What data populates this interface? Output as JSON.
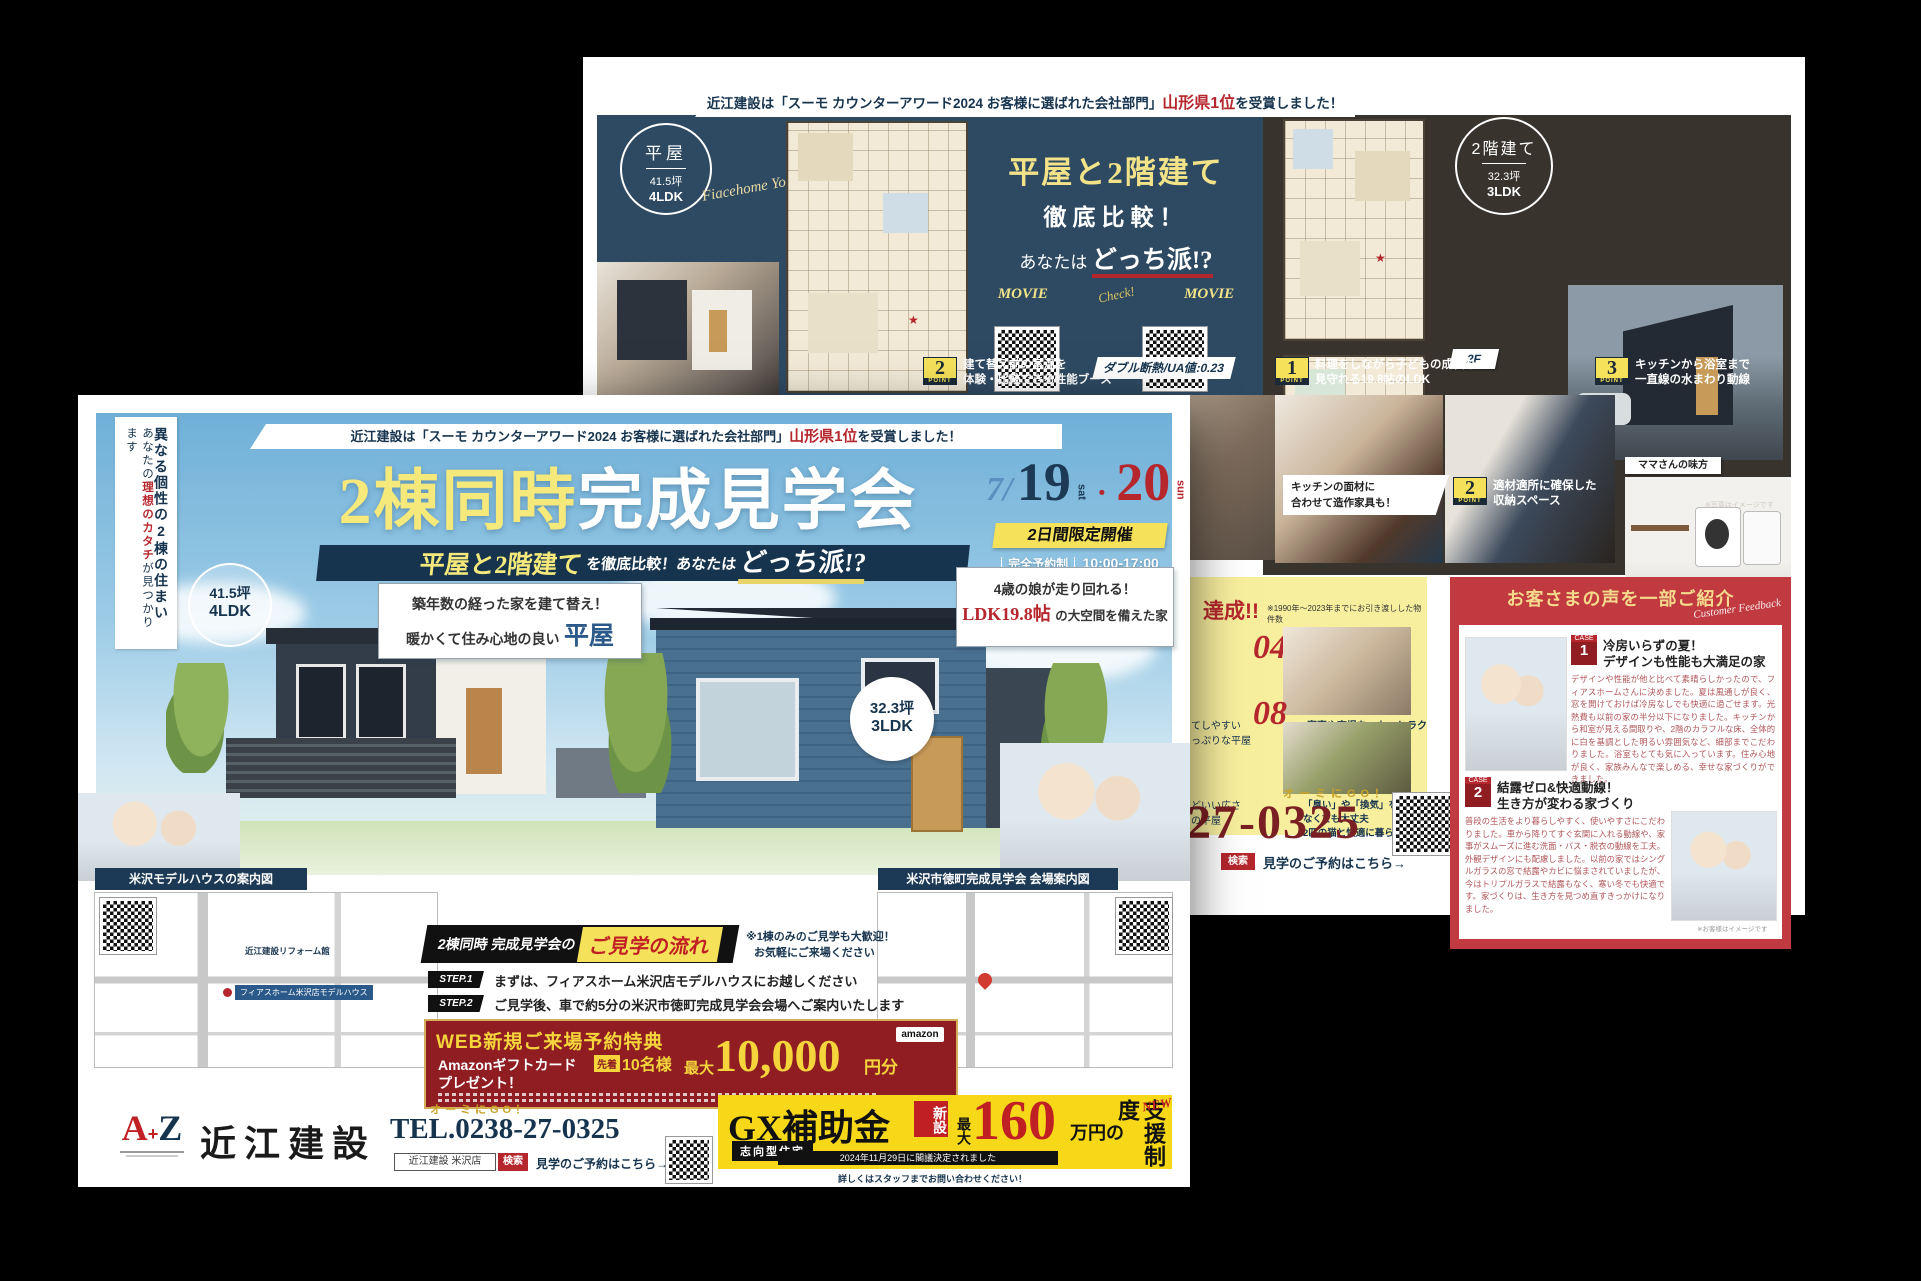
{
  "colors": {
    "navy": "#2e4a63",
    "dark_brown": "#38332d",
    "accent_red": "#b5272d",
    "accent_yellow": "#f2e388",
    "gx_yellow": "#f6d818",
    "voice_red": "#c13a3f",
    "section_yellow": "#f8ef9e"
  },
  "back": {
    "award": {
      "pre": "近江建設は「スーモ カウンターアワード2024 お客様に選ばれた会社部門」",
      "em": "山形県1位",
      "post": "を受賞しました！"
    },
    "hiraya": {
      "name": "平屋",
      "size": "41.5坪",
      "ldk": "4LDK"
    },
    "script": "Fiacehome Yonezawa",
    "title": {
      "l1": "平屋と2階建て",
      "l2": "徹底比較！",
      "l3pre": "あなたは",
      "l3em": "どっち派!?"
    },
    "movie": {
      "left": "MOVIE",
      "check": "Check!",
      "right": "MOVIE",
      "cap_left": "「平屋」内観イメージは\nこちらの動画をチェック！",
      "cap_right": "「2階建て」内観イメージは\nこちらの動画をチェック！"
    },
    "nikai": {
      "name": "2階建て",
      "size": "32.3坪",
      "ldk": "3LDK"
    },
    "tag2f": "2F",
    "tag1f": "1F",
    "point_word": "POINT",
    "ua": "ダブル断熱/UA値:0.23",
    "p2": {
      "num": "2",
      "text": "建て替え前の室温を\n体験・比較できる性能ブース"
    },
    "p1": {
      "num": "1",
      "text": "料理をしながら子どもの成長を\n見守れる19.8帖のLDK"
    },
    "p3": {
      "num": "3",
      "text": "キッチンから浴室まで\n一直線の水まわり動線"
    },
    "p2b": {
      "num": "2",
      "text": "適材適所に確保した\n収納スペース"
    },
    "cap_kagu": "キッチンの面材に\n合わせて造作家具も！",
    "mama": "ママさんの味方",
    "photo_note": "※写真はイメージです",
    "ach": {
      "tassei": "達成!!",
      "note": "※1990年～2023年までにお引き渡しした物件数",
      "i04": {
        "num": "04",
        "text": "家事や育児を、もっとラクに\n家族の笑顔が増える家"
      },
      "i08": {
        "num": "08",
        "text": "「臭い」や「換気」を気にしなくても大丈夫\n2匹の猫と快適に暮らせる家"
      },
      "frag1": "てしやすい\nっぷりな平屋",
      "frag2": "どいい広さ\nの平屋"
    },
    "contact": {
      "slogan": "オーミにGO！",
      "phone": "8-27-0325",
      "search": "検索",
      "reserve": "見学のご予約はこちら→"
    },
    "voice": {
      "header": "お客さまの声を一部ご紹介",
      "script": "Customer Feedback",
      "case_word": "CASE",
      "c1": {
        "num": "1",
        "t1": "冷房いらずの夏！",
        "t2": "デザインも性能も大満足の家",
        "body": "デザインや性能が他と比べて素晴らしかったので、フィアスホームさんに決めました。夏は風通しが良く、窓を開けておけば冷房なしでも快適に過ごせます。光熱費も以前の家の半分以下になりました。キッチンから和室が見える間取りや、2階のカラフルな床、全体的に白を基調とした明るい雰囲気など、細部までこだわりました。浴室もとても気に入っています。住み心地が良く、家族みんなで楽しめる、幸せな家づくりができました。"
      },
      "c2": {
        "num": "2",
        "t1": "結露ゼロ&快適動線！",
        "t2": "生き方が変わる家づくり",
        "body": "普段の生活をより暮らしやすく、使いやすさにこだわりました。車から降りてすぐ玄関に入れる動線や、家事がスムーズに進む洗面・バス・脱衣の動線を工夫。外観デザインにも配慮しました。以前の家ではシングルガラスの窓で結露やカビに悩まされていましたが、今はトリプルガラスで結露もなく、寒い冬でも快適です。家づくりは、生き方を見つめ直すきっかけになりました。"
      },
      "note": "※お客様はイメージです"
    }
  },
  "front": {
    "side": {
      "col1": "異なる個性の2棟の住まい",
      "col2pre": "あなたの",
      "col2em": "理想のカタチ",
      "col2post": "が見つかります"
    },
    "award": {
      "pre": "近江建設は「スーモ カウンターアワード2024 お客様に選ばれた会社部門」",
      "em": "山形県1位",
      "post": "を受賞しました！"
    },
    "title": {
      "em": "2棟同時",
      "rest": "完成見学会"
    },
    "sub": {
      "em1": "平屋と2階建て",
      "mid": "を徹底比較！あなたは",
      "em2": "どっち派!?"
    },
    "date": {
      "month": "7/",
      "d1": "19",
      "w1": "sat",
      "dot": "・",
      "d2": "20",
      "w2": "sun",
      "limited": "2日間限定開催",
      "reserve": "完全予約制",
      "time": "10:00-17:00"
    },
    "b41": {
      "size": "41.5坪",
      "ldk": "4LDK"
    },
    "b32": {
      "size": "32.3坪",
      "ldk": "3LDK"
    },
    "bubL": {
      "l1": "築年数の経った家を建て替え！",
      "l2pre": "暖かくて住み心地の良い",
      "l2em": "平屋"
    },
    "bubR": {
      "l1": "4歳の娘が走り回れる！",
      "l2em": "LDK19.8帖",
      "l2post": "の大空間を備えた家"
    },
    "mapL": {
      "tag": "米沢モデルハウスの案内図",
      "label1": "近江建設リフォーム館",
      "label2": "フィアスホーム米沢店モデルハウス"
    },
    "mapR": {
      "tag": "米沢市徳町完成見学会 会場案内図"
    },
    "flow": {
      "pre": "2棟同時 完成見学会の",
      "em": "ご見学の流れ",
      "note1": "※1棟のみのご見学も大歓迎！",
      "note2": "お気軽にご来場ください",
      "s1tag": "STEP.1",
      "s1": "まずは、フィアスホーム米沢店モデルハウスにお越しください",
      "s2tag": "STEP.2",
      "s2": "ご見学後、車で約5分の米沢市徳町完成見学会会場へご案内いたします"
    },
    "offer": {
      "title": "WEB新規ご来場予約特典",
      "l1": "Amazonギフトカード",
      "l2": "プレゼント！",
      "first": "先着",
      "count": "10名様",
      "max": "最大",
      "amount": "10,000",
      "unit": "円分",
      "amazon": "amazon"
    },
    "bottom": {
      "logoA": "A",
      "logoPlus": "+",
      "logoZ": "Z",
      "company": "近江建設",
      "slogan": "オーミにGO！",
      "tel": "TEL.0238-27-0325",
      "search_box": "近江建設 米沢店",
      "search_btn": "検索",
      "reserve": "見学のご予約はこちら→"
    },
    "gx": {
      "title": "GX補助金",
      "sub": "志向型住宅",
      "new_tag": "新設",
      "max": "最大",
      "amount": "160",
      "unit": "万円の",
      "label": "支援制度",
      "newword": "NEW",
      "note": "2024年11月29日に閣議決定されました",
      "ask": "詳しくはスタッフまでお問い合わせください！"
    }
  }
}
